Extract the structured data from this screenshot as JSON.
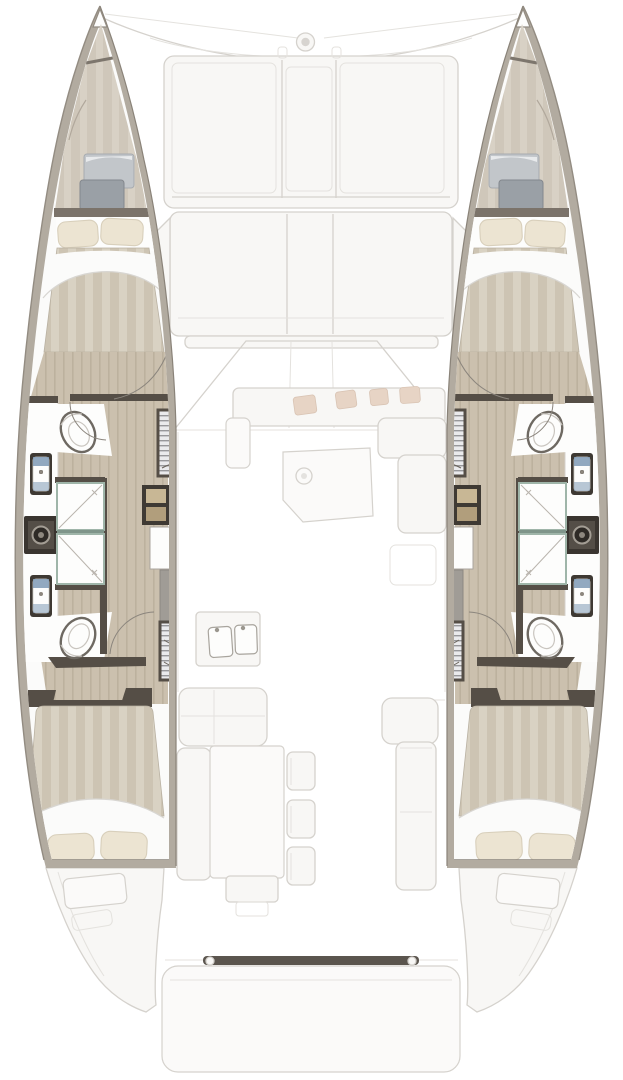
{
  "document": {
    "title": "Catamaran interior layout floor plan, top-down view",
    "view": "top-down deck plan",
    "vessel_type": "sailing catamaran"
  },
  "colors": {
    "page_bg": "#ffffff",
    "hull_rim": "#b2aba0",
    "hull_rim_dark": "#938c82",
    "wall": "#554e46",
    "wall_light": "#7b736a",
    "wood_floor": "#cbc0ae",
    "wood_floor_grain": "#bcb19e",
    "wallpaper": "#cfc7ba",
    "wallpaper_stripe": "#d8d1c5",
    "mattress": "#cdc4b3",
    "mattress_stripe": "#d9d2c3",
    "pillow": "#ece4d2",
    "pillow_shade": "#d8cfbb",
    "sheet": "#fbfbfa",
    "sheet_shade": "#d8d6d2",
    "fixture_white": "#fdfdfc",
    "fixture_line": "#aaa59e",
    "toilet_rim": "#6e6962",
    "sink_frame": "#3e3933",
    "basin_blue": "#7f9ab5",
    "shower_glass": "#9fb5a9",
    "locker_bg": "#eaeaec",
    "locker_slat": "#97979a",
    "step_wood": "#c8b795",
    "step_wood_dark": "#b19e7c",
    "hatch_top": "#c2c6ca",
    "hatch_bottom": "#9aa0a6",
    "cushion_tan": "#e7d4c5",
    "ghost_fill": "#f8f7f5",
    "ghost_line": "#d5d2cd",
    "ghost_line_soft": "#e4e2de",
    "transom_bar": "#5b554e"
  },
  "inventory": {
    "hulls": [
      {
        "side": "port",
        "spaces": [
          "forepeak-berth",
          "forward-head",
          "shower-room",
          "aft-head",
          "aft-double-cabin"
        ],
        "fixtures": [
          "toilet-forward",
          "toilet-aft",
          "sink-forward",
          "sink-aft",
          "washer",
          "shower-forward",
          "shower-aft",
          "wardrobe-forward",
          "wardrobe-aft",
          "companionway-stairs"
        ],
        "berths": [
          {
            "name": "forepeak-berth",
            "pillows": 2
          },
          {
            "name": "aft-double-berth",
            "pillows": 2
          }
        ]
      },
      {
        "side": "starboard",
        "spaces": [
          "forepeak-berth",
          "forward-head",
          "shower-room",
          "aft-head",
          "aft-double-cabin"
        ],
        "fixtures": [
          "toilet-forward",
          "toilet-aft",
          "sink-forward",
          "sink-aft",
          "washer",
          "shower-forward",
          "shower-aft",
          "wardrobe-forward",
          "wardrobe-aft",
          "companionway-stairs"
        ],
        "berths": [
          {
            "name": "forepeak-berth",
            "pillows": 2
          },
          {
            "name": "aft-double-berth",
            "pillows": 2
          }
        ]
      }
    ],
    "center_deck": {
      "bow": [
        "bow-fitting",
        "forestay-lines"
      ],
      "foredeck": [
        "sun-lounge",
        "forward-cockpit-bench"
      ],
      "saloon": [
        "windshield",
        "front-sofa",
        "saloon-table",
        "lounge-sofa",
        "chart-seat"
      ],
      "galley": [
        "double-sink",
        "stove"
      ],
      "aft_cockpit": [
        "corner-bench",
        "side-bench",
        "cockpit-table",
        "chairs-x3",
        "starboard-bench"
      ],
      "stern": [
        "transom-beam",
        "swim-platform",
        "engine-hatches"
      ]
    }
  }
}
